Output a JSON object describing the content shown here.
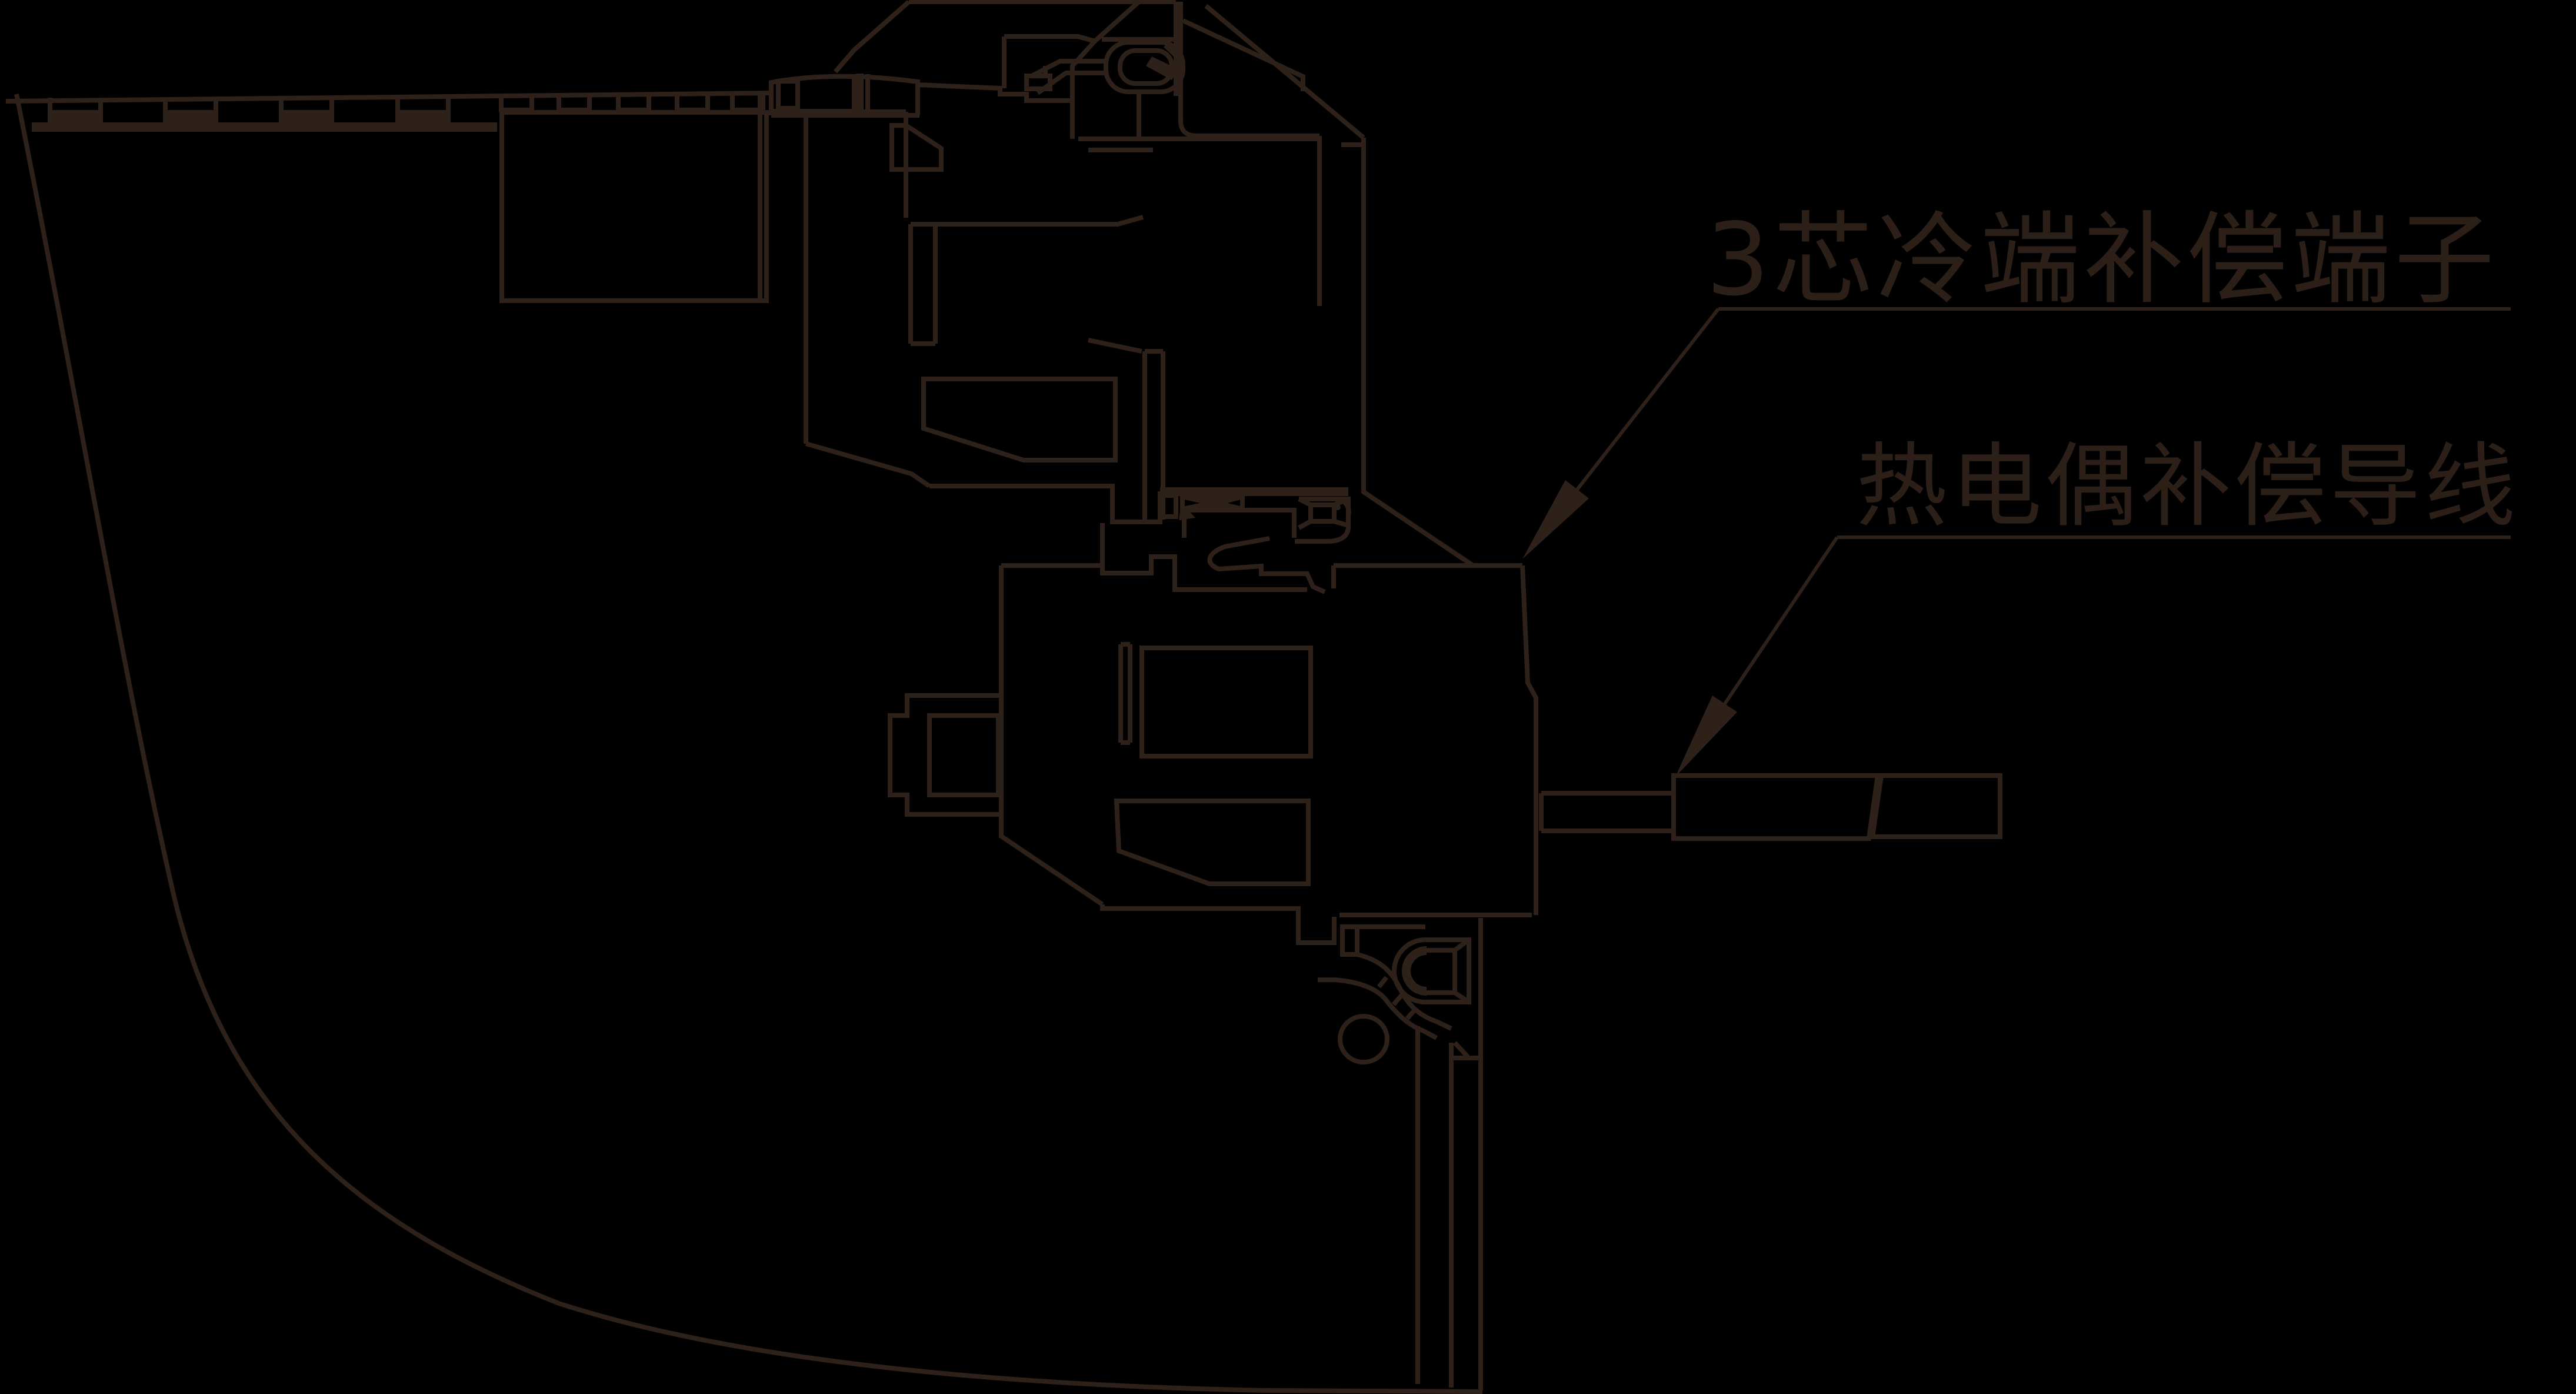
{
  "figure": {
    "background_color": "#000000",
    "line_color": "#2e211a",
    "text_color": "#2c1f18",
    "labels": [
      {
        "id": "cold-junction-terminal",
        "text": "3芯冷端补偿端子"
      },
      {
        "id": "thermocouple-compensation-wire",
        "text": "热电偶补偿导线"
      }
    ]
  }
}
